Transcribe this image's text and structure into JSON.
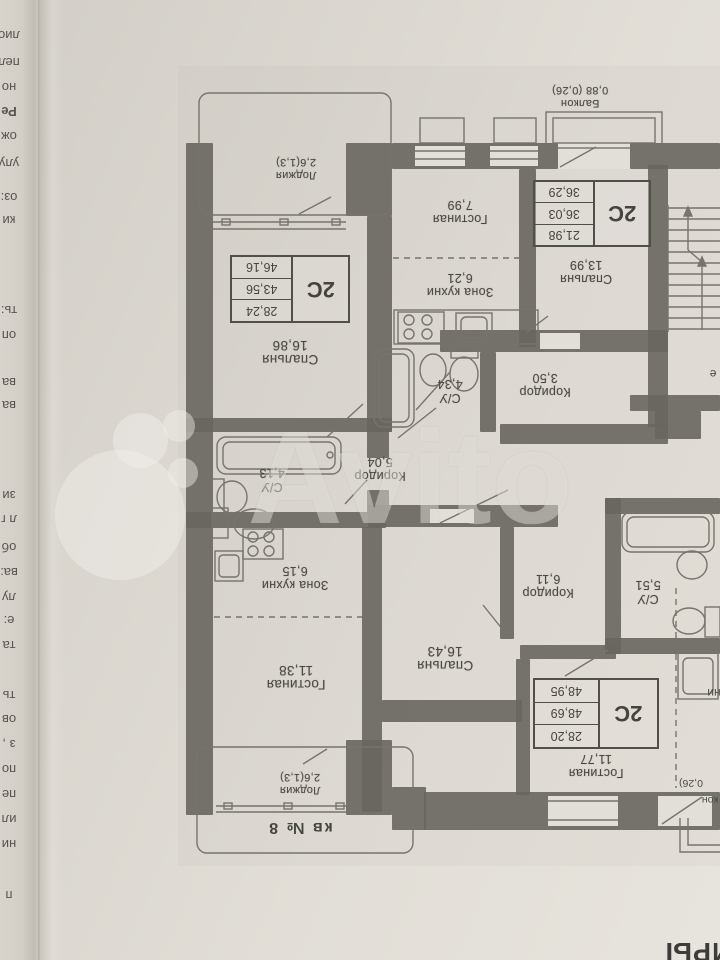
{
  "watermark": {
    "brand": "Avito"
  },
  "corner_text": "ИРЫ",
  "right_edge_letter": "е",
  "unit_label": "кв № 8",
  "rooms": {
    "loggia_top": {
      "name": "Лоджия",
      "area": "2,6(1,3)"
    },
    "bedroom_1686": {
      "name": "Спальня",
      "area": "16,86"
    },
    "su_413": {
      "name": "С/У",
      "area": "4,13"
    },
    "corridor_504": {
      "name": "Коридор",
      "area": "5,04"
    },
    "kitchen_615": {
      "name": "Зона кухни",
      "area": "6,15"
    },
    "living_1138": {
      "name": "Гостиная",
      "area": "11,38"
    },
    "loggia_bottom": {
      "name": "Лоджия",
      "area": "2,6(1,3)"
    },
    "living_799": {
      "name": "Гостиная",
      "area": "7,99"
    },
    "kitchen_621": {
      "name": "Зона кухни",
      "area": "6,21"
    },
    "su_434": {
      "name": "С/У",
      "area": "4,34"
    },
    "corridor_350": {
      "name": "Коридор",
      "area": "3,50"
    },
    "balcony_top": {
      "name": "Балкон",
      "area": "0,88 (0,26)"
    },
    "bedroom_1399": {
      "name": "Спальня",
      "area": "13,99"
    },
    "bedroom_1643": {
      "name": "Спальня",
      "area": "16,43"
    },
    "corridor_611": {
      "name": "Коридор",
      "area": "6,11"
    },
    "su_551": {
      "name": "С/У",
      "area": "5,51"
    },
    "living_1177": {
      "name": "Гостиная",
      "area": "11,77"
    },
    "kitchen_cut": {
      "name": "ни"
    },
    "balcony_cut": {
      "name": "кон",
      "area": "0,26)"
    }
  },
  "area_tables": {
    "apt_left": {
      "type": "2С",
      "rows": [
        "28,24",
        "43,56",
        "46,16"
      ]
    },
    "apt_top_right": {
      "type": "2С",
      "rows": [
        "21,98",
        "36,03",
        "36,29"
      ]
    },
    "apt_bottom_right": {
      "type": "2С",
      "rows": [
        "28,20",
        "48,69",
        "48,95"
      ]
    }
  },
  "edge_fragments": [
    {
      "text": "лио",
      "y": 28
    },
    {
      "text": "пел",
      "y": 55
    },
    {
      "text": "но",
      "y": 80
    },
    {
      "text": "Ре",
      "y": 104,
      "bold": true
    },
    {
      "text": "ож",
      "y": 129
    },
    {
      "text": "улу",
      "y": 156
    },
    {
      "text": "оз:",
      "y": 190
    },
    {
      "text": "ки",
      "y": 213
    },
    {
      "text": "ть:",
      "y": 303
    },
    {
      "text": "оп",
      "y": 328
    },
    {
      "text": "ва",
      "y": 375
    },
    {
      "text": "ва",
      "y": 398
    },
    {
      "text": "зи",
      "y": 488
    },
    {
      "text": "л г",
      "y": 512
    },
    {
      "text": "об",
      "y": 540
    },
    {
      "text": "ва:",
      "y": 565
    },
    {
      "text": "лу",
      "y": 590
    },
    {
      "text": "е:",
      "y": 613
    },
    {
      "text": "та",
      "y": 638
    },
    {
      "text": "ть",
      "y": 688
    },
    {
      "text": "ов",
      "y": 712
    },
    {
      "text": "з ,",
      "y": 737
    },
    {
      "text": "по",
      "y": 762
    },
    {
      "text": "пе",
      "y": 787
    },
    {
      "text": "ил",
      "y": 812
    },
    {
      "text": "ни",
      "y": 837
    },
    {
      "text": "п",
      "y": 888
    }
  ]
}
